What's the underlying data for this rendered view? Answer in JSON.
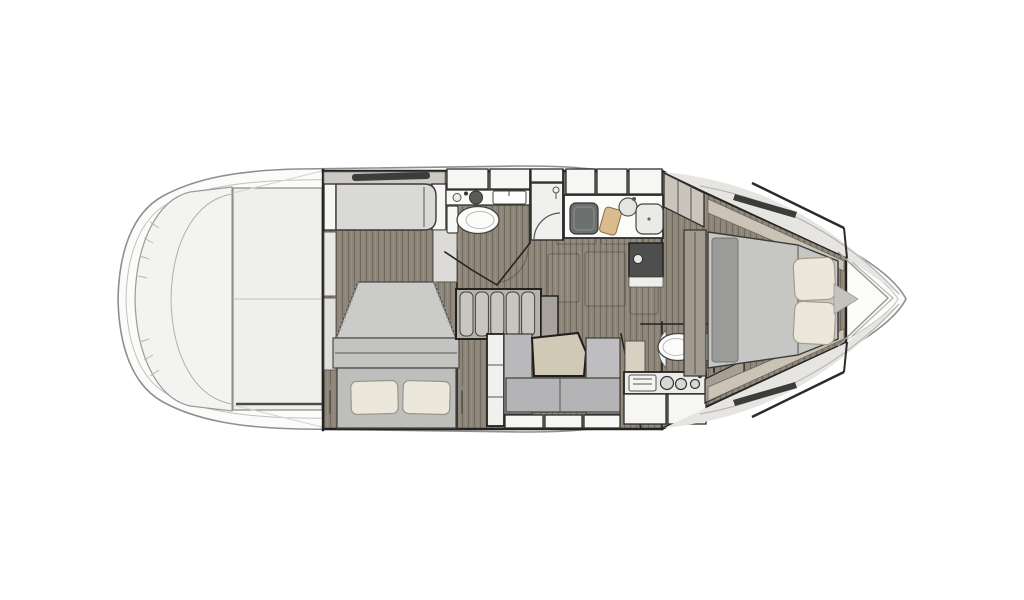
{
  "meta": {
    "description": "Top-view interior floor plan of a motor yacht lower deck, line-drawing style, no text labels",
    "width_px": 1024,
    "height_px": 600
  },
  "colors": {
    "background": "#ffffff",
    "hull_fill": "#fbfbfa",
    "hull_stroke": "#8f8f8f",
    "deck_shade": "#e6e5e2",
    "platform_fill": "#f3f3f2",
    "aft_deck_fill": "#efefee",
    "floor_wood": "#8e8579",
    "wall": "#232323",
    "furniture_white": "#f6f6f4",
    "furniture_light": "#d9d9d7",
    "sofa_gray": "#b9b9bb",
    "bed_gray": "#c6c6c5",
    "bed_dark": "#9b9b99",
    "pillow_cream": "#ebe7da",
    "table_beige": "#cfc9b6",
    "wood_cabinet": "#a79f94",
    "appliance_dark": "#4e4e4e",
    "sink_dark": "#6b6f6e",
    "cutting_board": "#d9bb8e",
    "window_dark": "#3c3c3c"
  },
  "rooms": {
    "swim_platform": "Swim platform (stern)",
    "aft_deck": "Aft deck / cockpit area",
    "aft_cabin": "Aft guest cabin with double berth and sofa",
    "head_main": "Main head with toilet and vanity",
    "shower": "Separate shower stall",
    "galley": "Galley with sink, prep board and appliance",
    "salon_floor": "Salon wood floor with deck hatches",
    "stairs": "Companionway stairs",
    "dinette": "Dinette with table and U-sofa",
    "day_head": "Second head with toilet",
    "aft_galley": "Galley counter with sink and cooktop",
    "bow_cabin": "Forward master cabin with island berth",
    "bow_deck": "Foredeck with chevron deck lines"
  }
}
